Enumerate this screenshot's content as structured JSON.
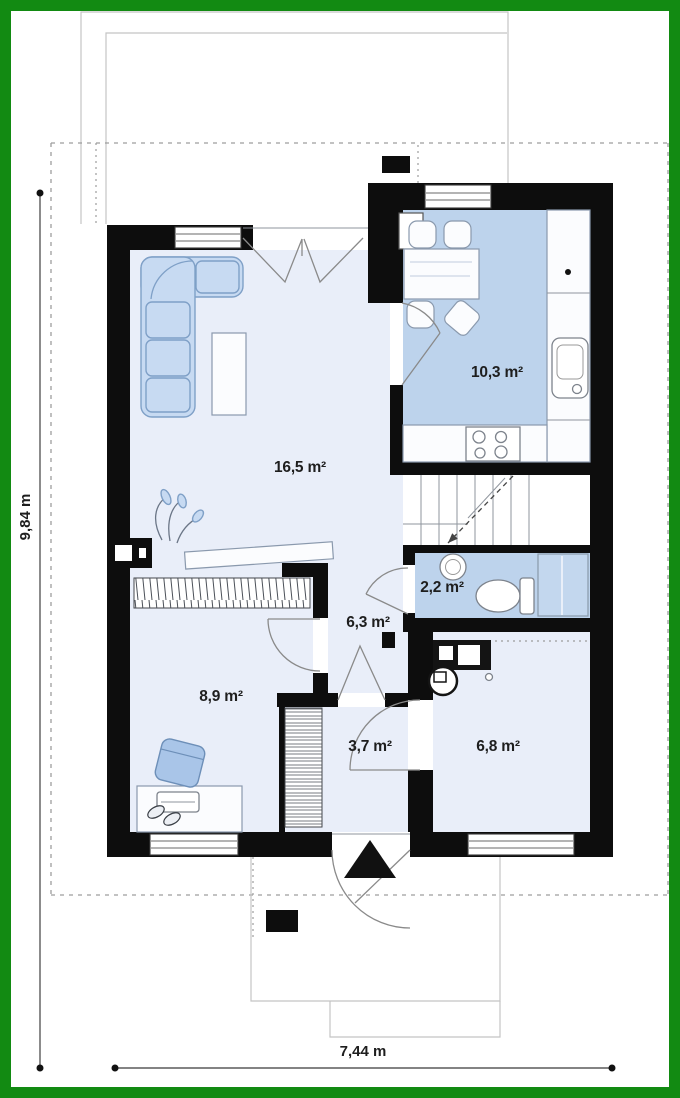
{
  "plan": {
    "rooms": [
      {
        "id": "living-room",
        "area_label": "16,5 m²"
      },
      {
        "id": "kitchen",
        "area_label": "10,3 m²"
      },
      {
        "id": "bathroom",
        "area_label": "2,2 m²"
      },
      {
        "id": "hall",
        "area_label": "6,3 m²"
      },
      {
        "id": "bedroom",
        "area_label": "8,9 m²"
      },
      {
        "id": "entry",
        "area_label": "3,7 m²"
      },
      {
        "id": "utility-room",
        "area_label": "6,8 m²"
      }
    ],
    "dimensions": {
      "height_label": "9,84 m",
      "width_label": "7,44 m"
    },
    "icons": {
      "entrance_arrow": "filled-up-triangle"
    },
    "colors": {
      "frame": "#128a12",
      "wall": "#0d0d0d",
      "floor_light": "#e9eef9",
      "floor_blue": "#bdd3ec",
      "furniture_blue": "#c7daf2",
      "furniture_outline": "#7fa0c7",
      "text": "#1e1e1e"
    }
  }
}
